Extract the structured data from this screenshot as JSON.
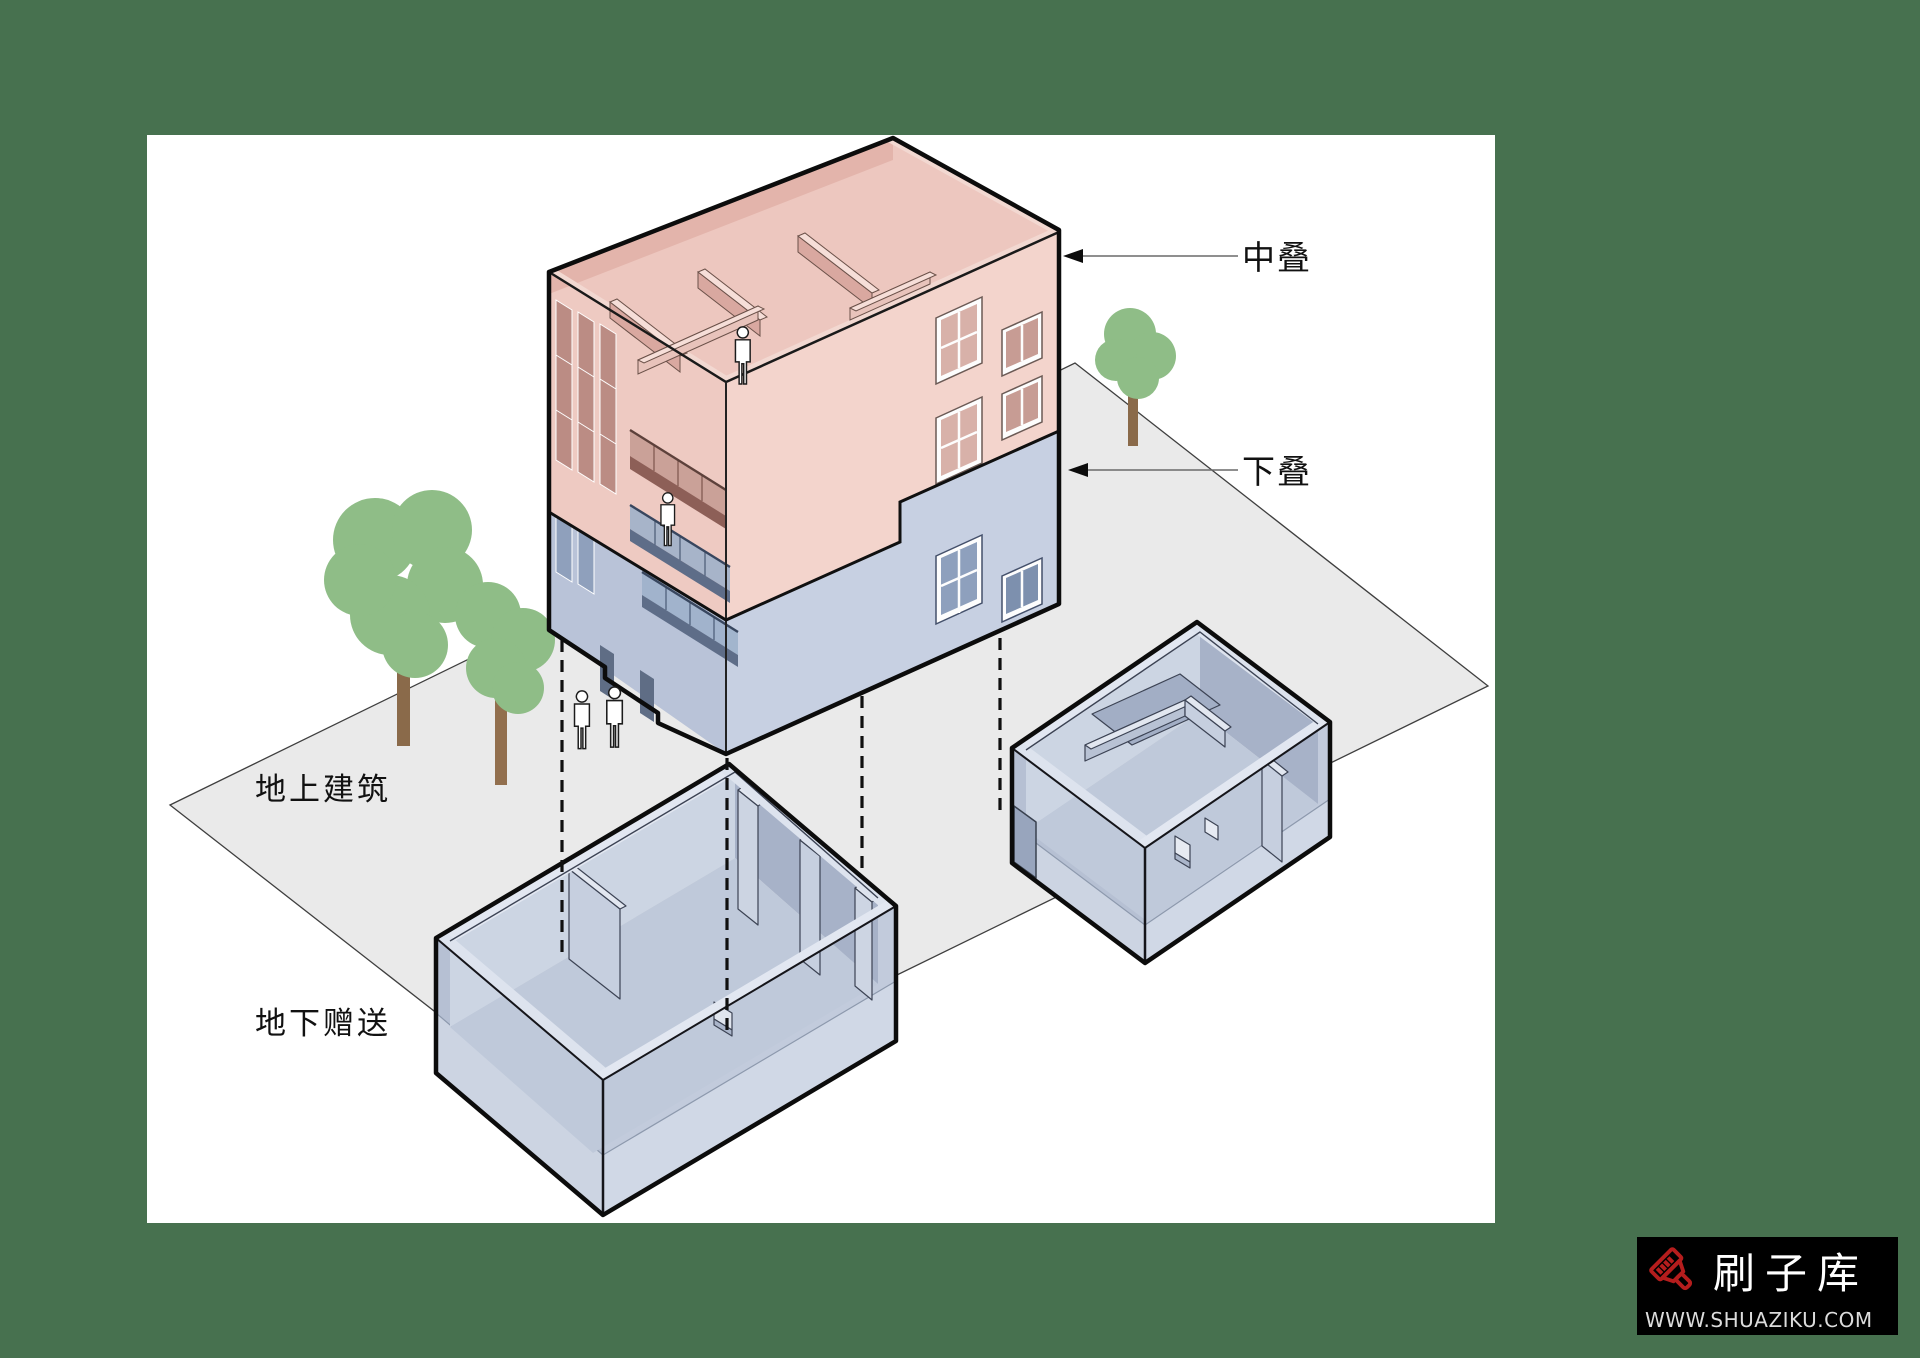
{
  "page": {
    "background": "#47714f",
    "canvas_color": "#ffffff"
  },
  "diagram": {
    "annotations": {
      "middle_stack": "中叠",
      "lower_stack": "下叠",
      "above_ground": "地上建筑",
      "underground_bonus": "地下赠送"
    },
    "colors": {
      "upper_section_pink": "#f3d4cc",
      "lower_section_blue": "#c7d0e2",
      "basement_blue": "#c2cbdc",
      "ground_plane": "#eaeaea",
      "tree_canopy": "#8fbd87",
      "tree_trunk": "#8a6a4a",
      "outline": "#0c0c0c"
    },
    "icons": [
      "tree-icon",
      "person-icon",
      "arrow-left-icon"
    ]
  },
  "watermark": {
    "brand": "刷子库",
    "url": "WWW.SHUAZIKU.COM",
    "brand_color": "#ffffff",
    "accent_color": "#b51d1d",
    "background": "#000000"
  }
}
